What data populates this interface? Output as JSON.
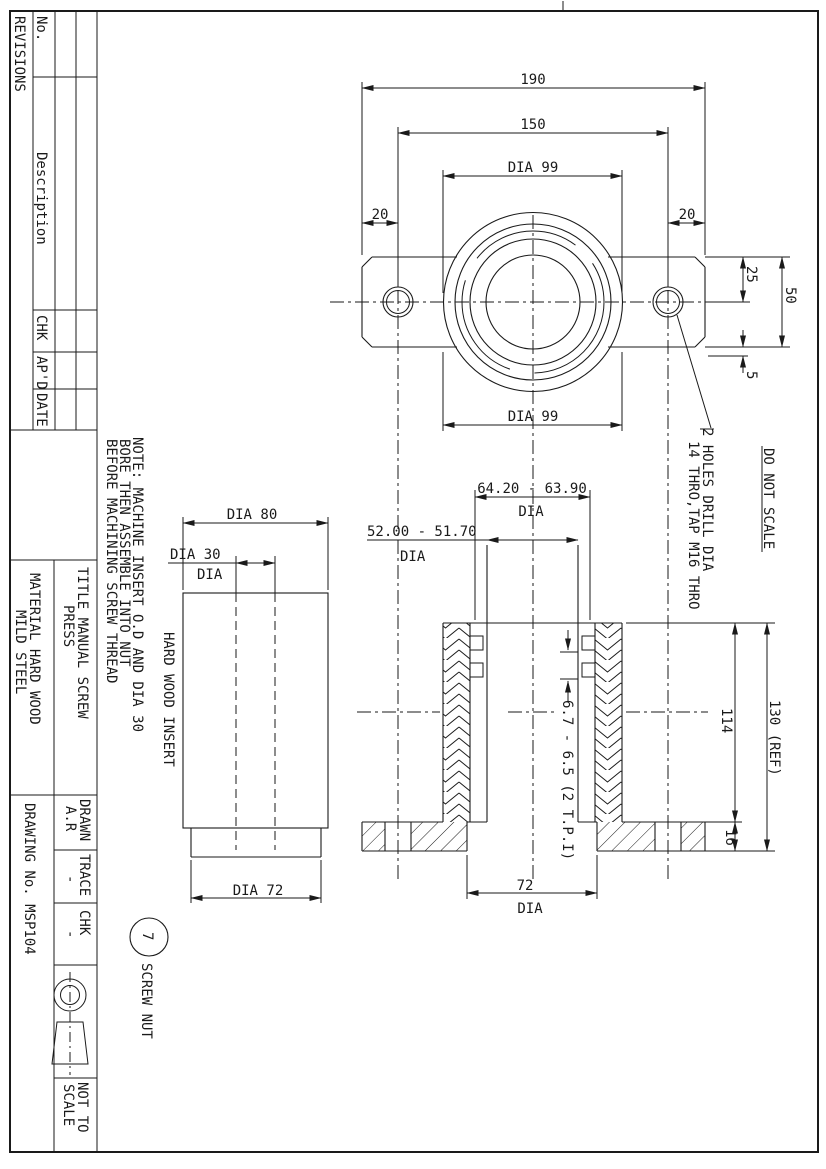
{
  "revisions_block": {
    "title": "REVISIONS",
    "col_no": "No.",
    "col_description": "Description",
    "col_chk": "CHK",
    "col_apd": "AP'D",
    "col_date": "DATE"
  },
  "note": {
    "line1": "NOTE: MACHINE INSERT O.D AND DIA 30",
    "line2": "BORE THEN ASSEMBLE INTO NUT",
    "line3": "BEFORE MACHINING SCREW THREAD"
  },
  "title_block": {
    "title_line1": "TITLE MANUAL SCREW",
    "title_line2": "PRESS",
    "material_line1": "MATERIAL HARD WOOD",
    "material_line2": "MILD STEEL",
    "drawing_no": "DRAWING No. MSP104",
    "drawn_label": "DRAWN",
    "drawn_value": "A.R",
    "trace_label": "TRACE",
    "trace_value": "-",
    "chk_label": "CHK",
    "chk_value": "-",
    "scale_note_line1": "NOT TO",
    "scale_note_line2": "SCALE"
  },
  "plan_view": {
    "dim_190": "190",
    "dim_150": "150",
    "dim_dia99_top": "DIA 99",
    "dim_20_left": "20",
    "dim_20_right": "20",
    "dim_dia99_bottom": "DIA 99",
    "dim_25": "25",
    "dim_50": "50",
    "dim_5": "5",
    "holes_note_line1": "2 HOLES DRILL DIA",
    "holes_note_line2": "14 THRO,TAP M16 THRO"
  },
  "do_not_scale": "DO NOT SCALE",
  "insert_view": {
    "dim_dia80": "DIA 80",
    "dim_dia30": "DIA 30",
    "dim_dia30_line2": "DIA",
    "label": "HARD WOOD INSERT",
    "dim_dia72": "DIA 72"
  },
  "section_view": {
    "dim_thread_od": "64.20 - 63.90",
    "dim_thread_od_line2": "DIA",
    "dim_bore": "52.00 - 51.70",
    "dim_bore_line2": "DIA",
    "dim_pitch": "6.7 - 6.5 (2 T.P.I)",
    "dim_114": "114",
    "dim_130": "130 (REF)",
    "dim_16": "16",
    "dim_72": "72",
    "dim_72_line2": "DIA"
  },
  "balloon": {
    "number": "7",
    "label": "SCREW NUT"
  }
}
